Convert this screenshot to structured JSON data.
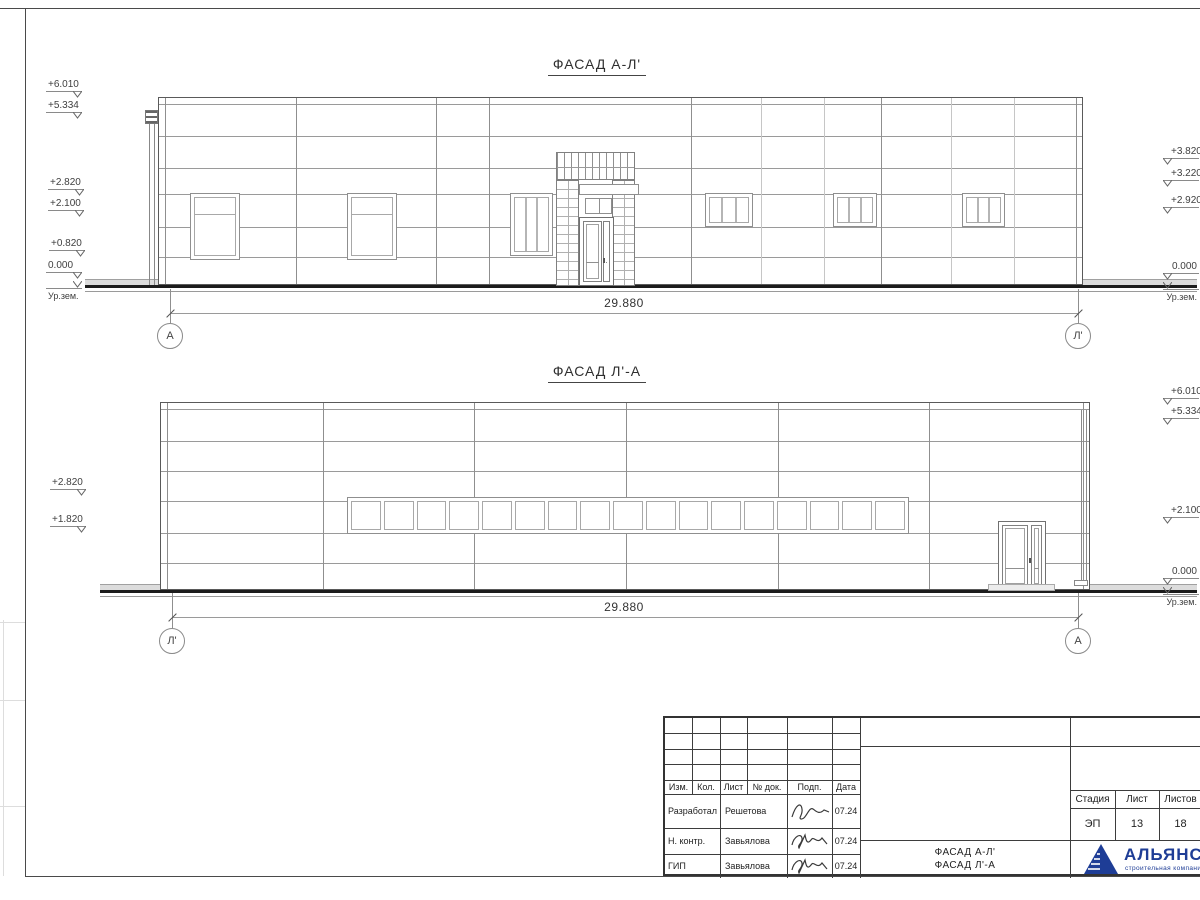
{
  "drawing": {
    "facade_top": {
      "title": "ФАСАД А-Л'",
      "dimension": "29.880",
      "axis_left": "А",
      "axis_right": "Л'",
      "marks_left": [
        "+6.010",
        "+5.334",
        "+2.820",
        "+2.100",
        "+0.820",
        "0.000"
      ],
      "marks_right": [
        "+3.820",
        "+3.220",
        "+2.920",
        "0.000"
      ],
      "ground_label": "Ур.зем."
    },
    "facade_bottom": {
      "title": "ФАСАД Л'-А",
      "dimension": "29.880",
      "axis_left": "Л'",
      "axis_right": "А",
      "marks_left": [
        "+2.820",
        "+1.820"
      ],
      "marks_right": [
        "+6.010",
        "+5.334",
        "+2.100",
        "0.000"
      ],
      "ground_label": "Ур.зем.",
      "ribbon_panes": 17
    }
  },
  "title_block": {
    "columns": [
      "Изм.",
      "Кол.",
      "Лист",
      "№ док.",
      "Подп.",
      "Дата"
    ],
    "rows": [
      {
        "role": "Разработал",
        "name": "Решетова",
        "date": "07.24"
      },
      {
        "role": "Н. контр.",
        "name": "Завьялова",
        "date": "07.24"
      },
      {
        "role": "ГИП",
        "name": "Завьялова",
        "date": "07.24"
      }
    ],
    "doc_title_line1": "ФАСАД А-Л'",
    "doc_title_line2": "ФАСАД Л'-А",
    "stage_columns": [
      "Стадия",
      "Лист",
      "Листов"
    ],
    "stage": "ЭП",
    "sheet": "13",
    "sheets": "18",
    "company_name": "АЛЬЯНС",
    "company_subtitle": "строительная компания",
    "brand_blue": "#1e3d96"
  }
}
